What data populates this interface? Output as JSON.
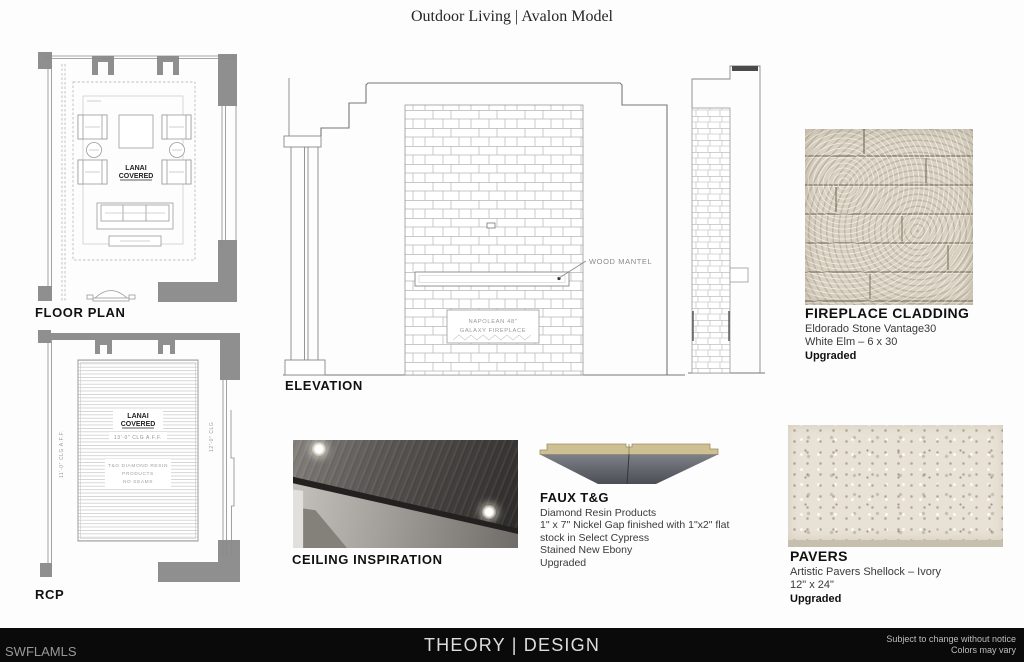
{
  "page": {
    "title": "Outdoor Living | Avalon Model"
  },
  "floor_plan": {
    "label": "FLOOR PLAN",
    "room_label_line1": "LANAI",
    "room_label_line2": "COVERED"
  },
  "rcp": {
    "label": "RCP",
    "room_label_line1": "LANAI",
    "room_label_line2": "COVERED",
    "ceiling_height": "13'-0\" CLG  A.F.F.",
    "note_line1": "T&G  DIAMOND  RESIN",
    "note_line2": "PRODUCTS",
    "note_line3": "NO  SEAMS",
    "left_height": "11'-0\"  CLG  A.F.F.",
    "right_height": "12'-0\"  CLG"
  },
  "elevation": {
    "label": "ELEVATION",
    "mantel_callout": "WOOD  MANTEL",
    "fireplace_line1": "NAPOLEAN  48\"",
    "fireplace_line2": "GALAXY  FIREPLACE"
  },
  "fireplace_cladding": {
    "title": "FIREPLACE CLADDING",
    "line1": "Eldorado Stone Vantage30",
    "line2": "White Elm – 6 x 30",
    "upgraded": "Upgraded"
  },
  "ceiling_inspiration": {
    "title": "CEILING INSPIRATION"
  },
  "faux_tg": {
    "title": "FAUX T&G",
    "line1": "Diamond Resin Products",
    "line2": "1\" x 7\" Nickel Gap finished with 1\"x2\" flat",
    "line3": "stock in Select Cypress",
    "line4": "Stained New Ebony",
    "upgraded": "Upgraded"
  },
  "pavers": {
    "title": "PAVERS",
    "line1": "Artistic Pavers Shellock – Ivory",
    "line2": "12\" x 24\"",
    "upgraded": "Upgraded"
  },
  "footer": {
    "left": "SWFLAMLS",
    "center": "THEORY | DESIGN",
    "right_line1": "Subject to change without notice",
    "right_line2": "Colors may vary"
  },
  "colors": {
    "footer_bg": "#0a0a0a",
    "wall_gray": "#8f8f8f",
    "drawing_line": "#8a8a8a",
    "stone_beige": "#d9d1c1",
    "paver_ivory": "#e8e2d6",
    "tg_wood_tan": "#cfc093",
    "tg_shadow_gray": "#4b4f55"
  }
}
